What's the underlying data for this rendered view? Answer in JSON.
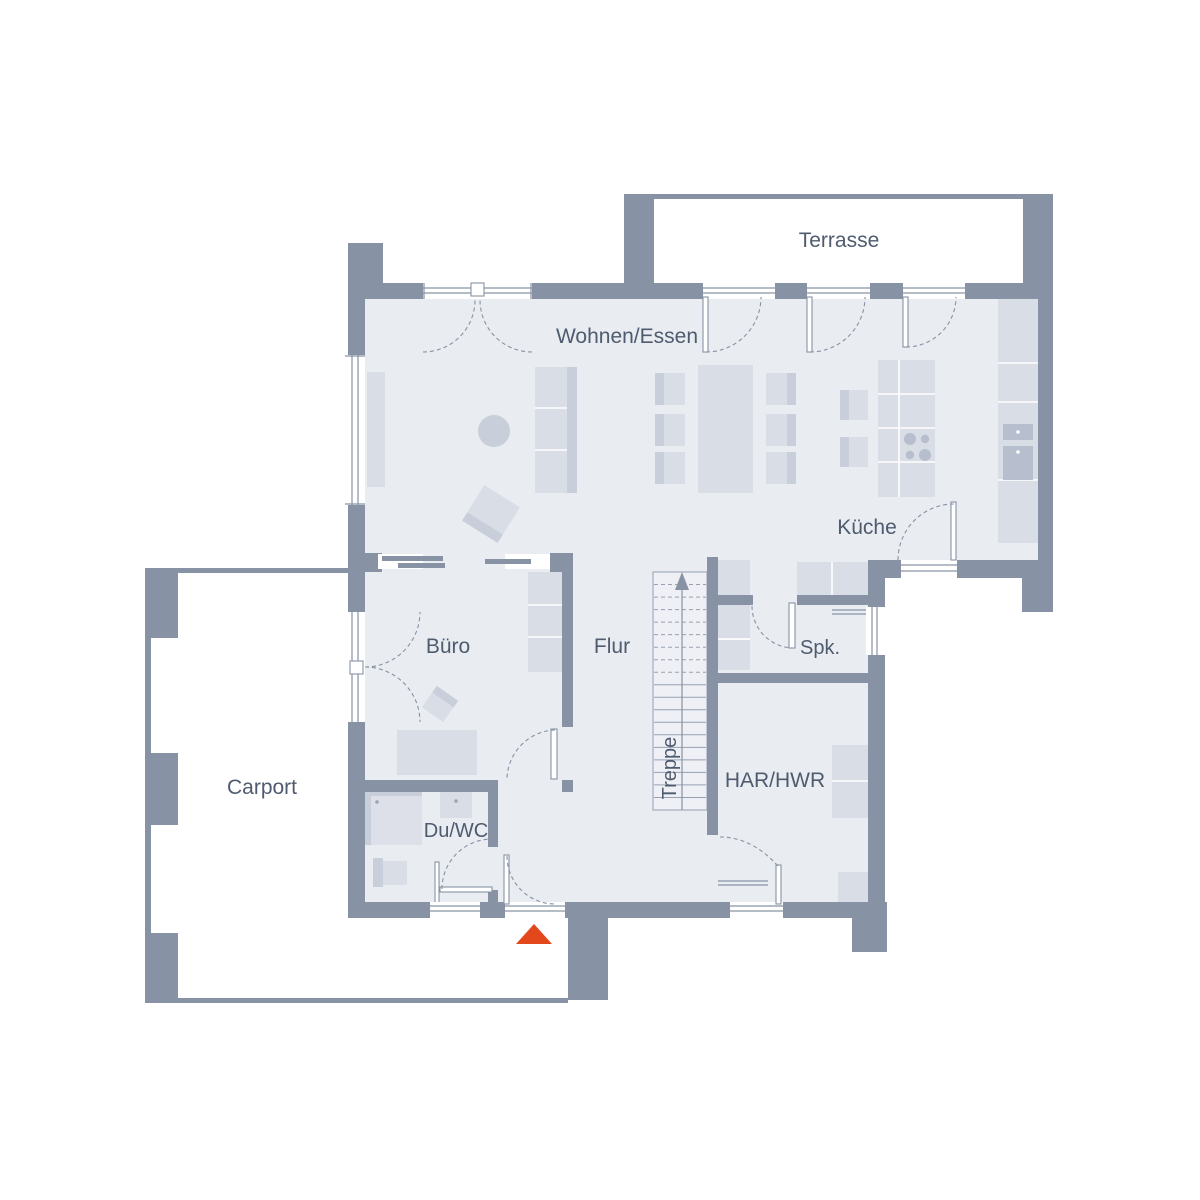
{
  "plan": {
    "type": "floor-plan",
    "language": "de",
    "rooms": {
      "terrasse": {
        "label": "Terrasse"
      },
      "wohnen_essen": {
        "label": "Wohnen/Essen"
      },
      "kueche": {
        "label": "Küche"
      },
      "buero": {
        "label": "Büro"
      },
      "flur": {
        "label": "Flur"
      },
      "treppe": {
        "label": "Treppe"
      },
      "spk": {
        "label": "Spk."
      },
      "har_hwr": {
        "label": "HAR/HWR"
      },
      "du_wc": {
        "label": "Du/WC"
      },
      "carport": {
        "label": "Carport"
      }
    },
    "stairs": {
      "tread_count": 18,
      "dashed_treads": 8,
      "direction": "up"
    },
    "entrance": {
      "marker": "red-triangle-arrow",
      "points_to": "main-entrance-door"
    }
  },
  "colors": {
    "wall": "#8793a5",
    "floor": "#e9ecf1",
    "furn_light": "#d9dde6",
    "furn_mid": "#c9cfda",
    "furn_dark": "#b7becd",
    "text": "#4f5b6e",
    "marker": "#e2481c",
    "background": "#ffffff"
  }
}
